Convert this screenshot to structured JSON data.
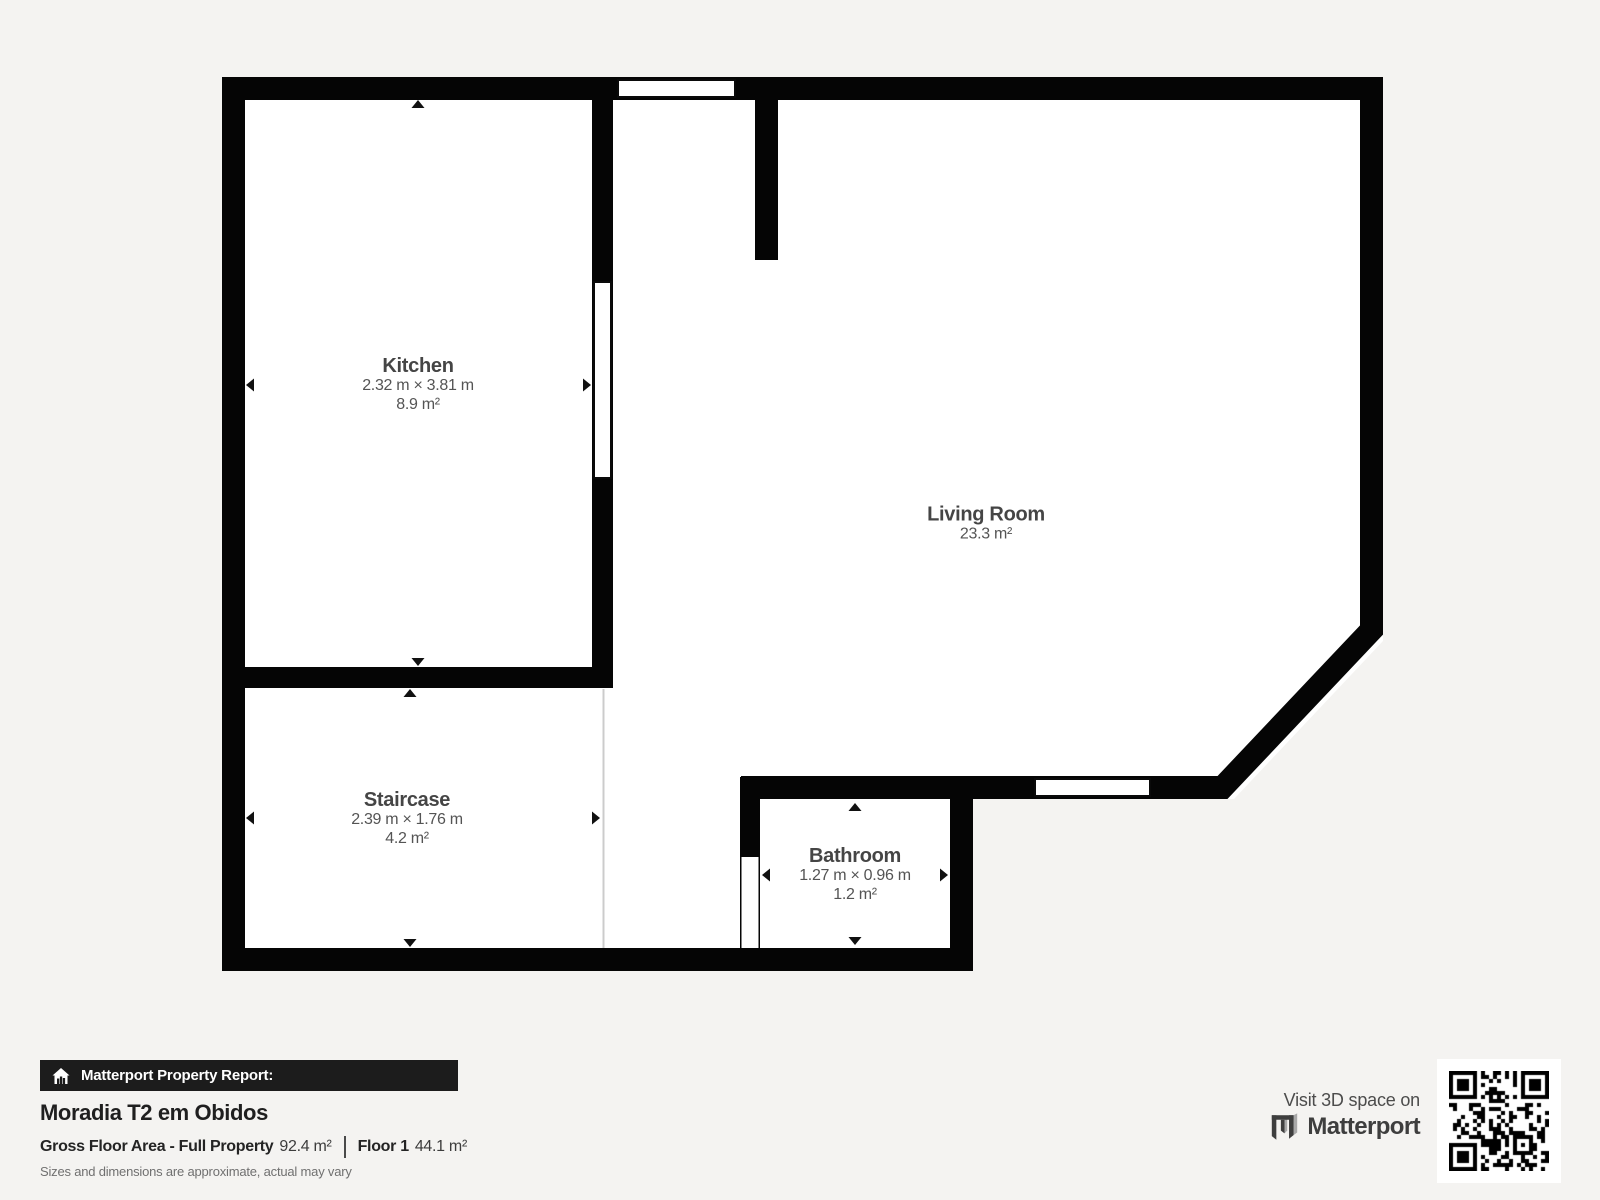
{
  "plan": {
    "rooms": {
      "kitchen": {
        "name": "Kitchen",
        "dimensions": "2.32 m × 3.81 m",
        "area": "8.9 m²"
      },
      "living_room": {
        "name": "Living Room",
        "area": "23.3 m²"
      },
      "staircase": {
        "name": "Staircase",
        "dimensions": "2.39 m × 1.76 m",
        "area": "4.2 m²"
      },
      "bathroom": {
        "name": "Bathroom",
        "dimensions": "1.27 m × 0.96 m",
        "area": "1.2 m²"
      }
    }
  },
  "report": {
    "badge_label": "Matterport Property Report:",
    "property_title": "Moradia T2 em Obidos",
    "gross_floor_area_label": "Gross Floor Area - Full Property",
    "gross_floor_area_value": "92.4 m²",
    "floor_label": "Floor 1",
    "floor_value": "44.1 m²",
    "disclaimer": "Sizes and dimensions are approximate, actual may vary"
  },
  "cta": {
    "visit_text": "Visit 3D space on",
    "brand": "Matterport"
  },
  "colors": {
    "background": "#f4f3f1",
    "floor": "#ffffff",
    "wall": "#000000",
    "badge_background": "#1c1c1c",
    "brand_dark": "#3e3e3e",
    "brand_light": "#a8a8a8",
    "text_muted": "#707070"
  }
}
